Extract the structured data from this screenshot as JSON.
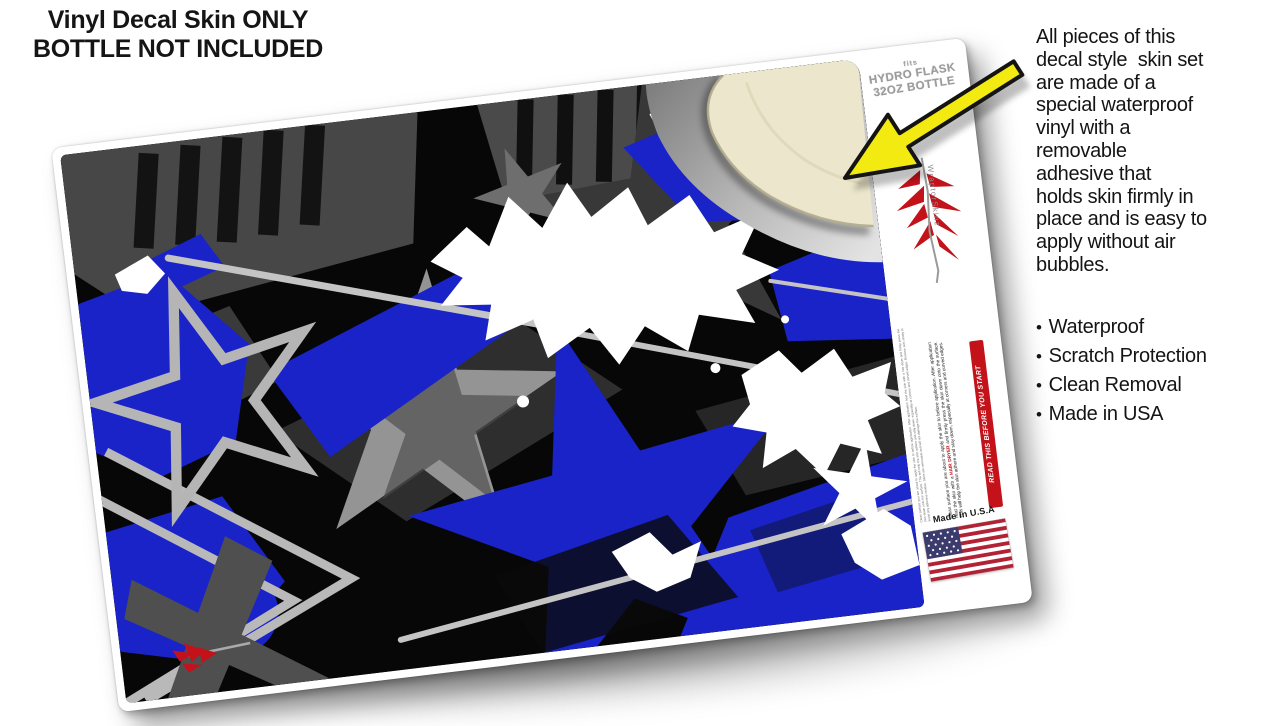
{
  "note": {
    "line1": "Vinyl Decal Skin ONLY",
    "line2": "BOTTLE NOT INCLUDED"
  },
  "info_panel": {
    "lines": [
      "All pieces of this",
      "decal style  skin set",
      "are made of a",
      "special waterproof",
      "vinyl with a",
      "removable",
      "adhesive that",
      "holds skin firmly in",
      "place and is easy to",
      "apply without air",
      "bubbles."
    ],
    "bullet_char": "•",
    "bullets": [
      "Waterproof",
      "Scratch Protection",
      "Clean Removal",
      "Made in USA"
    ]
  },
  "decal": {
    "fits": {
      "prefix": "fits",
      "line1": "Hydro Flask",
      "line2": "32oz Bottle"
    },
    "brand_vertical_text": "WraptorSkinz",
    "warning_banner": "READ THIS BEFORE YOU START",
    "instructions_before": "Clean surface you are about to apply the skin to before application. After application heat the skin with a ",
    "instructions_highlight": "HAIR DRYER",
    "instructions_after": " and firmly press the skin down onto the surface. This will help the skin adhere and stay down, especially at corners and curved edges.",
    "fine_print": "Clean surface you are about to apply the skin to before application. After application heat the skin with a hair dryer and firmly press the skin down onto the surface. This will help the skin adhere and stay down, especially at corners and curved edges. Remove skin slowly to avoid any adhesive residue. Skins are removable and will not damage the surface.",
    "made_in": "Made In U.S.A"
  },
  "colors": {
    "accent_blue": "#1a23c8",
    "brand_red": "#c3121a",
    "arrow_yellow": "#f2ea11",
    "peel_cream": "#ece6cc",
    "star_gray": "#3f3f3f",
    "streak_gray": "#c4c4c4"
  }
}
